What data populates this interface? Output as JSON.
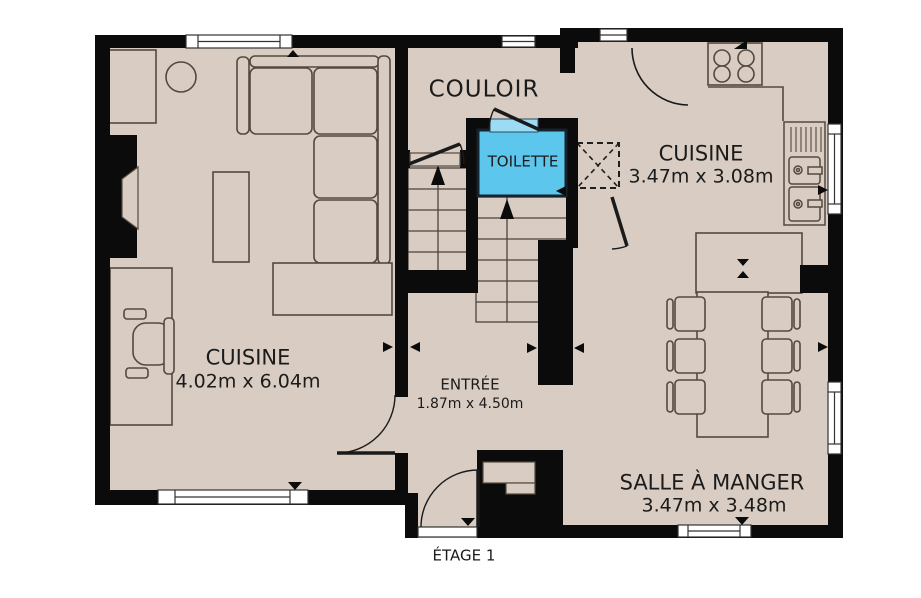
{
  "floor_plan": {
    "title": "ÉTAGE 1",
    "rooms": {
      "living": {
        "name": "CUISINE",
        "dims": "4.02m x 6.04m"
      },
      "hallway": {
        "name": "COULOIR"
      },
      "toilet": {
        "name": "TOILETTE"
      },
      "kitchen": {
        "name": "CUISINE",
        "dims": "3.47m x 3.08m"
      },
      "entry": {
        "name": "ENTRÉE",
        "dims": "1.87m x 4.50m"
      },
      "dining": {
        "name": "SALLE À MANGER",
        "dims": "3.47m x 3.48m"
      }
    },
    "colors": {
      "floor": "#d9cdc3",
      "wall": "#0b0b0b",
      "furniture_outline": "#54493d",
      "toilet_fill": "#5cc6ec",
      "toilet_sill": "#9bdcf4",
      "window": "#ffffff",
      "text": "#1b1b1b"
    },
    "icons": [
      "sofa",
      "chaise",
      "coffee-table",
      "round-table",
      "corner-cabinet",
      "fireplace",
      "desk",
      "office-chair",
      "stairs-up",
      "stove",
      "kitchen-sink",
      "dishwasher",
      "counter-peninsula",
      "dining-table",
      "dining-chair",
      "door-swing",
      "window",
      "dimension-arrow"
    ]
  }
}
